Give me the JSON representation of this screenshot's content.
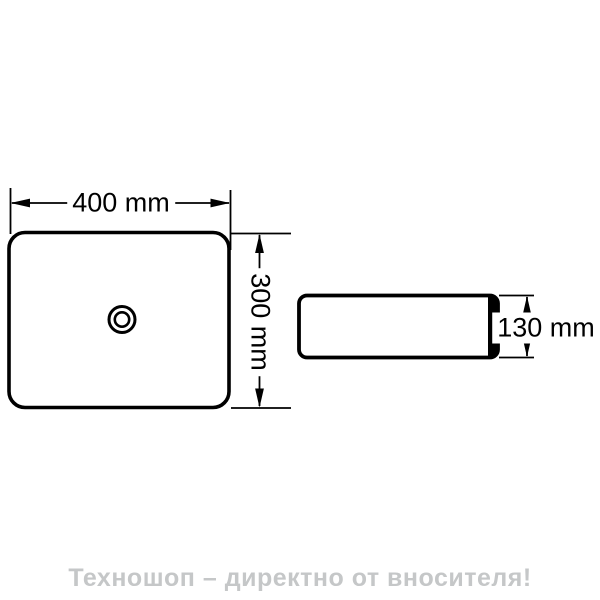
{
  "drawing": {
    "dimensions": {
      "width": {
        "label": "400 mm",
        "value": 400,
        "unit": "mm"
      },
      "depth": {
        "label": "300 mm",
        "value": 300,
        "unit": "mm"
      },
      "height": {
        "label": "130 mm",
        "value": 130,
        "unit": "mm"
      }
    },
    "icons": {
      "drain": "drain-icon"
    }
  },
  "footer": {
    "caption": "Техношоп – директно от вносителя!"
  },
  "colors": {
    "line": "#000000",
    "background": "#ffffff",
    "caption_text": "#c5c7c8"
  }
}
